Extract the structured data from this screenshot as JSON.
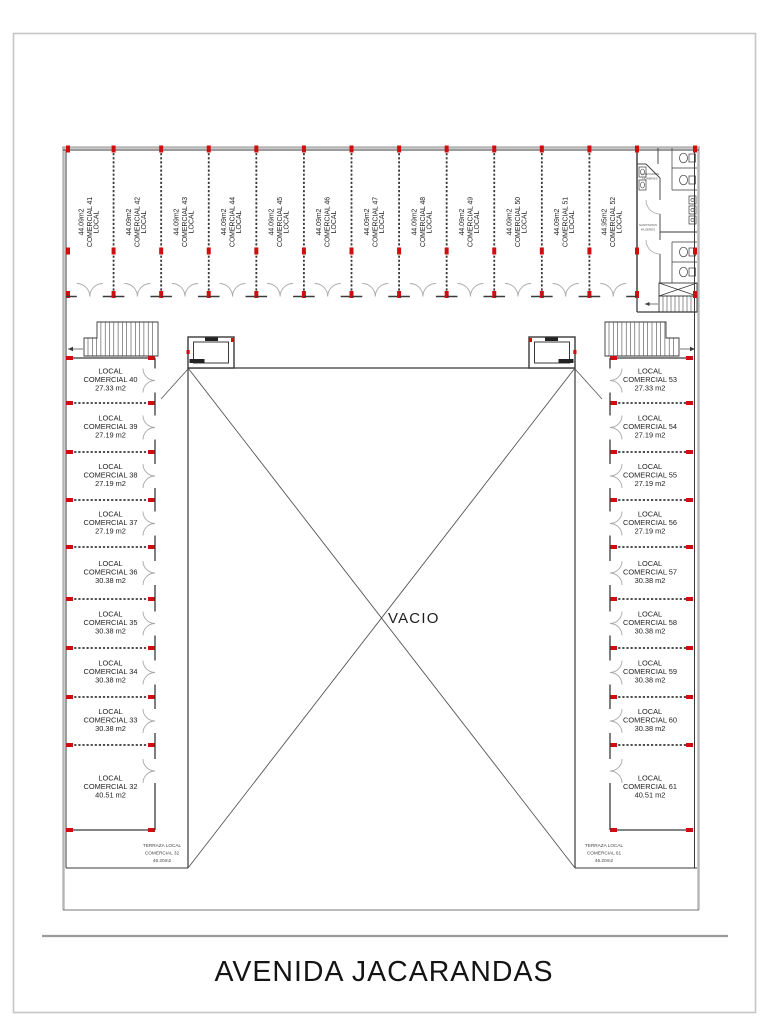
{
  "page": {
    "title": "AVENIDA JACARANDAS"
  },
  "plan": {
    "void_label": "VACIO",
    "colors": {
      "column_red": "#cf0f0f",
      "wall_dark": "#3a3a3a",
      "wall_grey": "#b5b5b5",
      "arc_grey": "#a9a9a9",
      "border_grey": "#c6c6c6",
      "street_grey": "#9a9a9a"
    },
    "top_units": [
      {
        "line1": "LOCAL",
        "line2": "COMERCIAL 41",
        "line3": "44.09m2"
      },
      {
        "line1": "LOCAL",
        "line2": "COMERCIAL 42",
        "line3": "44.09m2"
      },
      {
        "line1": "LOCAL",
        "line2": "COMERCIAL 43",
        "line3": "44.09m2"
      },
      {
        "line1": "LOCAL",
        "line2": "COMERCIAL 44",
        "line3": "44.09m2"
      },
      {
        "line1": "LOCAL",
        "line2": "COMERCIAL 45",
        "line3": "44.09m2"
      },
      {
        "line1": "LOCAL",
        "line2": "COMERCIAL 46",
        "line3": "44.09m2"
      },
      {
        "line1": "LOCAL",
        "line2": "COMERCIAL 47",
        "line3": "44.09m2"
      },
      {
        "line1": "LOCAL",
        "line2": "COMERCIAL 48",
        "line3": "44.09m2"
      },
      {
        "line1": "LOCAL",
        "line2": "COMERCIAL 49",
        "line3": "44.09m2"
      },
      {
        "line1": "LOCAL",
        "line2": "COMERCIAL 50",
        "line3": "44.09m2"
      },
      {
        "line1": "LOCAL",
        "line2": "COMERCIAL 51",
        "line3": "44.09m2"
      },
      {
        "line1": "LOCAL",
        "line2": "COMERCIAL 52",
        "line3": "44.95m2"
      }
    ],
    "left_units": [
      {
        "line1": "LOCAL",
        "line2": "COMERCIAL 40",
        "line3": "27.33 m2"
      },
      {
        "line1": "LOCAL",
        "line2": "COMERCIAL 39",
        "line3": "27.19 m2"
      },
      {
        "line1": "LOCAL",
        "line2": "COMERCIAL 38",
        "line3": "27.19 m2"
      },
      {
        "line1": "LOCAL",
        "line2": "COMERCIAL 37",
        "line3": "27.19 m2"
      },
      {
        "line1": "LOCAL",
        "line2": "COMERCIAL 36",
        "line3": "30.38 m2"
      },
      {
        "line1": "LOCAL",
        "line2": "COMERCIAL 35",
        "line3": "30.38 m2"
      },
      {
        "line1": "LOCAL",
        "line2": "COMERCIAL 34",
        "line3": "30.38 m2"
      },
      {
        "line1": "LOCAL",
        "line2": "COMERCIAL 33",
        "line3": "30.38 m2"
      },
      {
        "line1": "LOCAL",
        "line2": "COMERCIAL 32",
        "line3": "40.51 m2"
      }
    ],
    "right_units": [
      {
        "line1": "LOCAL",
        "line2": "COMERCIAL 53",
        "line3": "27.33 m2"
      },
      {
        "line1": "LOCAL",
        "line2": "COMERCIAL 54",
        "line3": "27.19 m2"
      },
      {
        "line1": "LOCAL",
        "line2": "COMERCIAL 55",
        "line3": "27.19 m2"
      },
      {
        "line1": "LOCAL",
        "line2": "COMERCIAL 56",
        "line3": "27.19 m2"
      },
      {
        "line1": "LOCAL",
        "line2": "COMERCIAL 57",
        "line3": "30.38 m2"
      },
      {
        "line1": "LOCAL",
        "line2": "COMERCIAL 58",
        "line3": "30.38 m2"
      },
      {
        "line1": "LOCAL",
        "line2": "COMERCIAL 59",
        "line3": "30.38 m2"
      },
      {
        "line1": "LOCAL",
        "line2": "COMERCIAL 60",
        "line3": "30.38 m2"
      },
      {
        "line1": "LOCAL",
        "line2": "COMERCIAL 61",
        "line3": "40.51 m2"
      }
    ],
    "terrace_left": {
      "line1": "TERRAZA LOCAL",
      "line2": "COMERCIAL 32",
      "line3": "46.20m2"
    },
    "terrace_right": {
      "line1": "TERRAZA LOCAL",
      "line2": "COMERCIAL 61",
      "line3": "46.20m2"
    },
    "restroom": {
      "label_top_line1": "SANITARIOS",
      "label_top_line2": "HOMBRES",
      "label_bot_line1": "SANITARIOS",
      "label_bot_line2": "MUJERES"
    }
  }
}
